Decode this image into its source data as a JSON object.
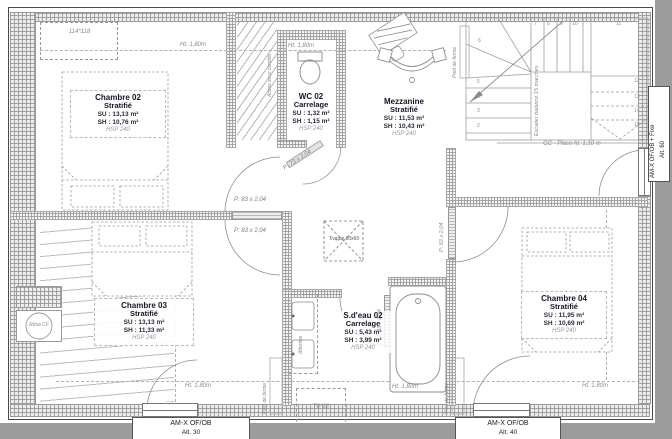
{
  "rooms": {
    "chambre02": {
      "name": "Chambre 02",
      "finish": "Stratifié",
      "su": "SU : 13,13 m²",
      "sh": "SH : 10,76 m²",
      "hsp": "HSP 240"
    },
    "wc02": {
      "name": "WC 02",
      "finish": "Carrelage",
      "su": "SU : 1,32 m²",
      "sh": "SH : 1,15 m²",
      "hsp": "HSP 240"
    },
    "mezzanine": {
      "name": "Mezzanine",
      "finish": "Stratifié",
      "su": "SU : 11,53 m²",
      "sh": "SH : 10,43 m²",
      "hsp": "HSP 240"
    },
    "chambre03": {
      "name": "Chambre 03",
      "finish": "Stratifié",
      "su": "SU : 13,13 m²",
      "sh": "SH : 11,33 m²",
      "hsp": "HSP 240"
    },
    "sdeau02": {
      "name": "S.d'eau 02",
      "finish": "Carrelage",
      "su": "SU : 5,43 m²",
      "sh": "SH : 3,99 m²",
      "hsp": "HSP 240"
    },
    "chambre04": {
      "name": "Chambre 04",
      "finish": "Stratifié",
      "su": "SU : 11,95 m²",
      "sh": "SH : 10,69 m²",
      "hsp": "HSP 240"
    }
  },
  "doors": {
    "ch02": "P: 83 x 2,04",
    "ch03": "P: 83 x 2,04",
    "wc": "P: 73 x 2,04",
    "sdeau": "83 x 2,04",
    "ch04": "P: 83 x 2,04"
  },
  "windows": {
    "bottom_left_l1": "AM-X OF/OB",
    "bottom_left_l2": "Alt. 30",
    "bottom_right_l1": "AM-X OF/OB",
    "bottom_right_l2": "Alt. 40",
    "right_l1": "AM-X OF/OB + Fixe",
    "right_l2": "Alt. 60",
    "velux_top": "114*118",
    "velux_bottom": "78*98"
  },
  "annotations": {
    "height": "Ht. 1,80m",
    "trappe": "Trappe 60x60",
    "stair_note": "Escalier balancé 15 marches",
    "stair_guard": "GC - Placo ht. 1,10 m",
    "attic_access": "Accès sous comble",
    "truss_foot": "Pied de ferme",
    "reservation": "Résa CF",
    "waiting": "Attentes"
  },
  "stairs": {
    "numbers": [
      "2",
      "3",
      "4",
      "5",
      "6",
      "7",
      "8",
      "9",
      "10",
      "11",
      "12",
      "13",
      "14",
      "15"
    ]
  }
}
